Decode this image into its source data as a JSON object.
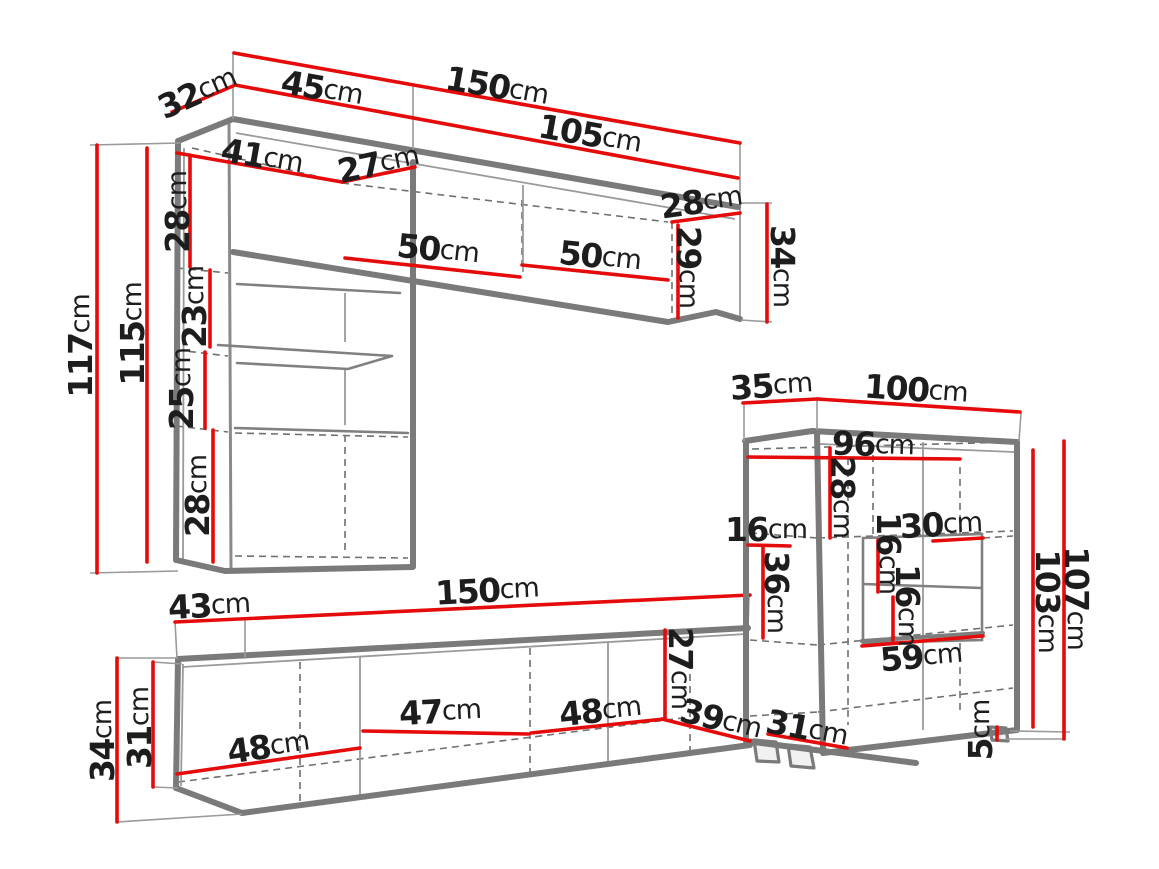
{
  "diagram": {
    "type": "furniture-dimension-diagram",
    "subject": "Wall unit furniture set technical drawing with dimensions",
    "unit": "cm",
    "colors": {
      "dimension_line": "#e60b0b",
      "furniture_outline": "#7a7a7a",
      "label_text": "#1d1d1d",
      "background": "#ffffff"
    },
    "pieces": [
      {
        "name": "upper wall cabinet with tall left column",
        "dimensions_cm": [
          32,
          45,
          150,
          105,
          41,
          27,
          28,
          117,
          115,
          23,
          25,
          28,
          50,
          50,
          28,
          29,
          34
        ]
      },
      {
        "name": "right side cabinet with open niche",
        "dimensions_cm": [
          35,
          100,
          96,
          28,
          16,
          36,
          16,
          30,
          16,
          59,
          103,
          107,
          5,
          39,
          31
        ]
      },
      {
        "name": "low tv stand",
        "dimensions_cm": [
          43,
          150,
          34,
          31,
          48,
          47,
          48,
          27
        ]
      }
    ],
    "labels": [
      {
        "id": "32-top-depth",
        "value": "32",
        "unit": "cm",
        "x": 197,
        "y": 92,
        "rot": -24
      },
      {
        "id": "45-top-width",
        "value": "45",
        "unit": "cm",
        "x": 322,
        "y": 88,
        "rot": 10
      },
      {
        "id": "150-top-width",
        "value": "150",
        "unit": "cm",
        "x": 497,
        "y": 86,
        "rot": 10
      },
      {
        "id": "105-top-width",
        "value": "105",
        "unit": "cm",
        "x": 590,
        "y": 134,
        "rot": 10
      },
      {
        "id": "41-inner-width",
        "value": "41",
        "unit": "cm",
        "x": 262,
        "y": 156,
        "rot": 10
      },
      {
        "id": "27-inner-depth",
        "value": "27",
        "unit": "cm",
        "x": 378,
        "y": 163,
        "rot": -12
      },
      {
        "id": "28-column-top",
        "value": "28",
        "unit": "cm",
        "x": 177,
        "y": 212,
        "rot": -90
      },
      {
        "id": "117-column-height",
        "value": "117",
        "unit": "cm",
        "x": 80,
        "y": 346,
        "rot": -90
      },
      {
        "id": "115-column-height",
        "value": "115",
        "unit": "cm",
        "x": 132,
        "y": 334,
        "rot": -90
      },
      {
        "id": "23-shelf-gap",
        "value": "23",
        "unit": "cm",
        "x": 194,
        "y": 307,
        "rot": -90
      },
      {
        "id": "25-shelf-gap",
        "value": "25",
        "unit": "cm",
        "x": 181,
        "y": 389,
        "rot": -90
      },
      {
        "id": "28-column-bottom",
        "value": "28",
        "unit": "cm",
        "x": 197,
        "y": 496,
        "rot": -90
      },
      {
        "id": "50-cabinet-left",
        "value": "50",
        "unit": "cm",
        "x": 438,
        "y": 249,
        "rot": 6
      },
      {
        "id": "50-cabinet-right",
        "value": "50",
        "unit": "cm",
        "x": 600,
        "y": 256,
        "rot": 6
      },
      {
        "id": "28-cabinet-end-depth",
        "value": "28",
        "unit": "cm",
        "x": 701,
        "y": 201,
        "rot": -8
      },
      {
        "id": "29-cabinet-end-inner",
        "value": "29",
        "unit": "cm",
        "x": 689,
        "y": 267,
        "rot": 90
      },
      {
        "id": "34-cabinet-end-height",
        "value": "34",
        "unit": "cm",
        "x": 783,
        "y": 266,
        "rot": 90
      },
      {
        "id": "35-sideboard-depth",
        "value": "35",
        "unit": "cm",
        "x": 771,
        "y": 385,
        "rot": -4
      },
      {
        "id": "100-sideboard-width",
        "value": "100",
        "unit": "cm",
        "x": 916,
        "y": 389,
        "rot": 4
      },
      {
        "id": "96-sideboard-inner",
        "value": "96",
        "unit": "cm",
        "x": 873,
        "y": 444,
        "rot": 2
      },
      {
        "id": "28-sideboard-top",
        "value": "28",
        "unit": "cm",
        "x": 843,
        "y": 497,
        "rot": 90
      },
      {
        "id": "16-sideboard-left",
        "value": "16",
        "unit": "cm",
        "x": 766,
        "y": 529,
        "rot": 0
      },
      {
        "id": "36-sideboard-left",
        "value": "36",
        "unit": "cm",
        "x": 777,
        "y": 592,
        "rot": 90
      },
      {
        "id": "16-niche-upper",
        "value": "16",
        "unit": "cm",
        "x": 889,
        "y": 553,
        "rot": 90
      },
      {
        "id": "30-niche-width",
        "value": "30",
        "unit": "cm",
        "x": 941,
        "y": 524,
        "rot": -3
      },
      {
        "id": "16-niche-lower",
        "value": "16",
        "unit": "cm",
        "x": 908,
        "y": 605,
        "rot": 90
      },
      {
        "id": "59-niche-bottom",
        "value": "59",
        "unit": "cm",
        "x": 921,
        "y": 656,
        "rot": -5
      },
      {
        "id": "103-sideboard-body",
        "value": "103",
        "unit": "cm",
        "x": 1048,
        "y": 601,
        "rot": 90
      },
      {
        "id": "107-sideboard-total",
        "value": "107",
        "unit": "cm",
        "x": 1077,
        "y": 598,
        "rot": 90
      },
      {
        "id": "5-foot-height",
        "value": "5",
        "unit": "cm",
        "x": 980,
        "y": 730,
        "rot": -90
      },
      {
        "id": "39-sideboard-depth",
        "value": "39",
        "unit": "cm",
        "x": 721,
        "y": 719,
        "rot": 14
      },
      {
        "id": "31-sideboard-bottom",
        "value": "31",
        "unit": "cm",
        "x": 807,
        "y": 728,
        "rot": 11
      },
      {
        "id": "43-stand-depth",
        "value": "43",
        "unit": "cm",
        "x": 209,
        "y": 605,
        "rot": -3
      },
      {
        "id": "150-stand-width",
        "value": "150",
        "unit": "cm",
        "x": 487,
        "y": 590,
        "rot": -3
      },
      {
        "id": "34-stand-height",
        "value": "34",
        "unit": "cm",
        "x": 102,
        "y": 741,
        "rot": -90
      },
      {
        "id": "31-stand-inner",
        "value": "31",
        "unit": "cm",
        "x": 139,
        "y": 728,
        "rot": -90
      },
      {
        "id": "48-stand-left",
        "value": "48",
        "unit": "cm",
        "x": 268,
        "y": 746,
        "rot": -8
      },
      {
        "id": "47-stand-middle",
        "value": "47",
        "unit": "cm",
        "x": 440,
        "y": 711,
        "rot": -3
      },
      {
        "id": "48-stand-right",
        "value": "48",
        "unit": "cm",
        "x": 600,
        "y": 710,
        "rot": -6
      },
      {
        "id": "27-stand-end",
        "value": "27",
        "unit": "cm",
        "x": 681,
        "y": 668,
        "rot": 90
      }
    ]
  }
}
